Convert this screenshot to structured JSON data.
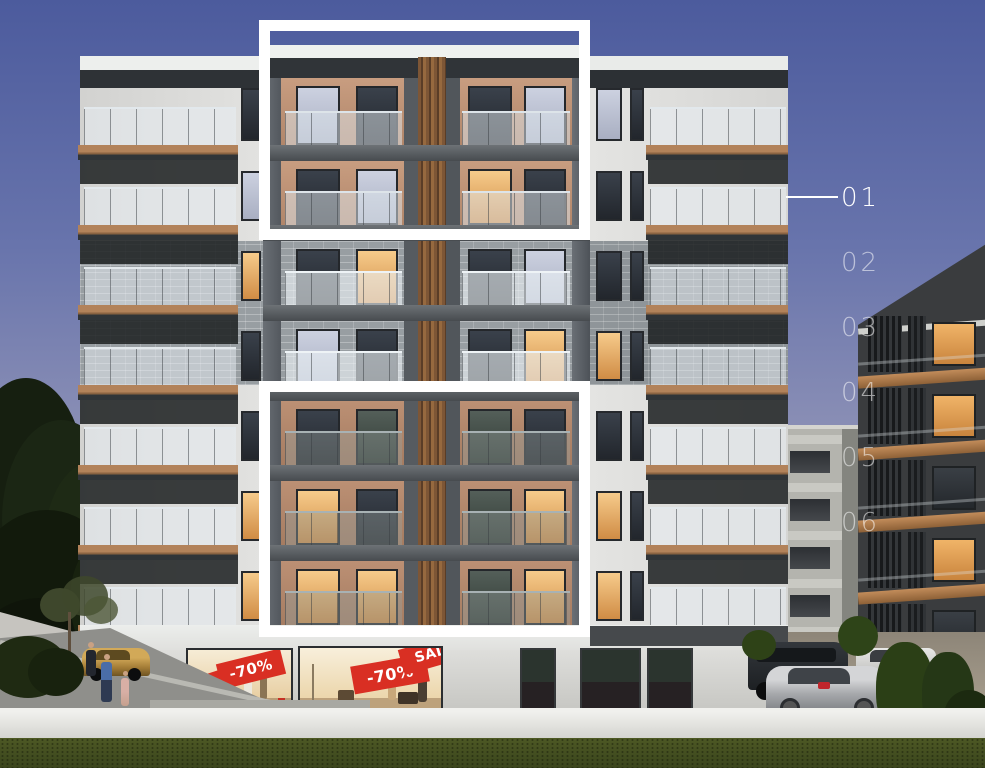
{
  "floor_selector": {
    "floors": [
      {
        "label": "01",
        "active": true
      },
      {
        "label": "02",
        "active": false
      },
      {
        "label": "03",
        "active": false
      },
      {
        "label": "04",
        "active": false
      },
      {
        "label": "05",
        "active": false
      },
      {
        "label": "06",
        "active": false
      }
    ]
  },
  "storefront": {
    "discount_banner": "-70%",
    "sale_banner": "SALE"
  },
  "colors": {
    "sky_top": "#4c5b9d",
    "sky_horizon": "#aea7b6",
    "highlight_white": "#ffffff",
    "label_dim": "rgba(255,255,255,0.55)",
    "banner_red": "#d92f23",
    "wood_accent": "#b2825a",
    "terracotta": "#bf9477",
    "brick_gray": "#989ea2",
    "grass_green": "#47521f"
  }
}
